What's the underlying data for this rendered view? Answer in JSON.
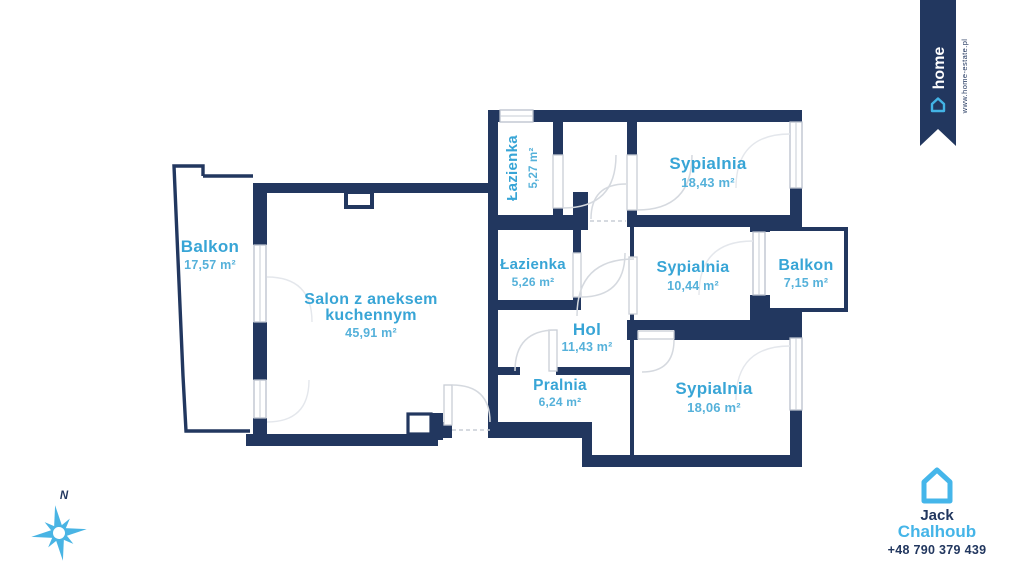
{
  "branding": {
    "ribbon": {
      "logo_text": "home",
      "website": "www.home-estate.pl"
    },
    "agent": {
      "first_name": "Jack",
      "last_name": "Chalhoub",
      "phone": "+48 790 379 439"
    },
    "compass_label": "N"
  },
  "colors": {
    "wall": "#22375f",
    "room_label": "#38a5d6",
    "accent": "#45b5e8"
  },
  "floor_plan": {
    "rooms": [
      {
        "id": "balkon-left",
        "name": "Balkon",
        "area": "17,57 m²"
      },
      {
        "id": "salon",
        "name": "Salon z aneksem",
        "name2": "kuchennym",
        "area": "45,91 m²"
      },
      {
        "id": "lazienka-top",
        "name": "Łazienka",
        "area": "5,27 m²"
      },
      {
        "id": "sypialnia-1",
        "name": "Sypialnia",
        "area": "18,43 m²"
      },
      {
        "id": "lazienka-2",
        "name": "Łazienka",
        "area": "5,26 m²"
      },
      {
        "id": "sypialnia-2",
        "name": "Sypialnia",
        "area": "10,44 m²"
      },
      {
        "id": "balkon-right",
        "name": "Balkon",
        "area": "7,15 m²"
      },
      {
        "id": "hol",
        "name": "Hol",
        "area": "11,43 m²"
      },
      {
        "id": "pralnia",
        "name": "Pralnia",
        "area": "6,24 m²"
      },
      {
        "id": "sypialnia-3",
        "name": "Sypialnia",
        "area": "18,06 m²"
      }
    ]
  }
}
